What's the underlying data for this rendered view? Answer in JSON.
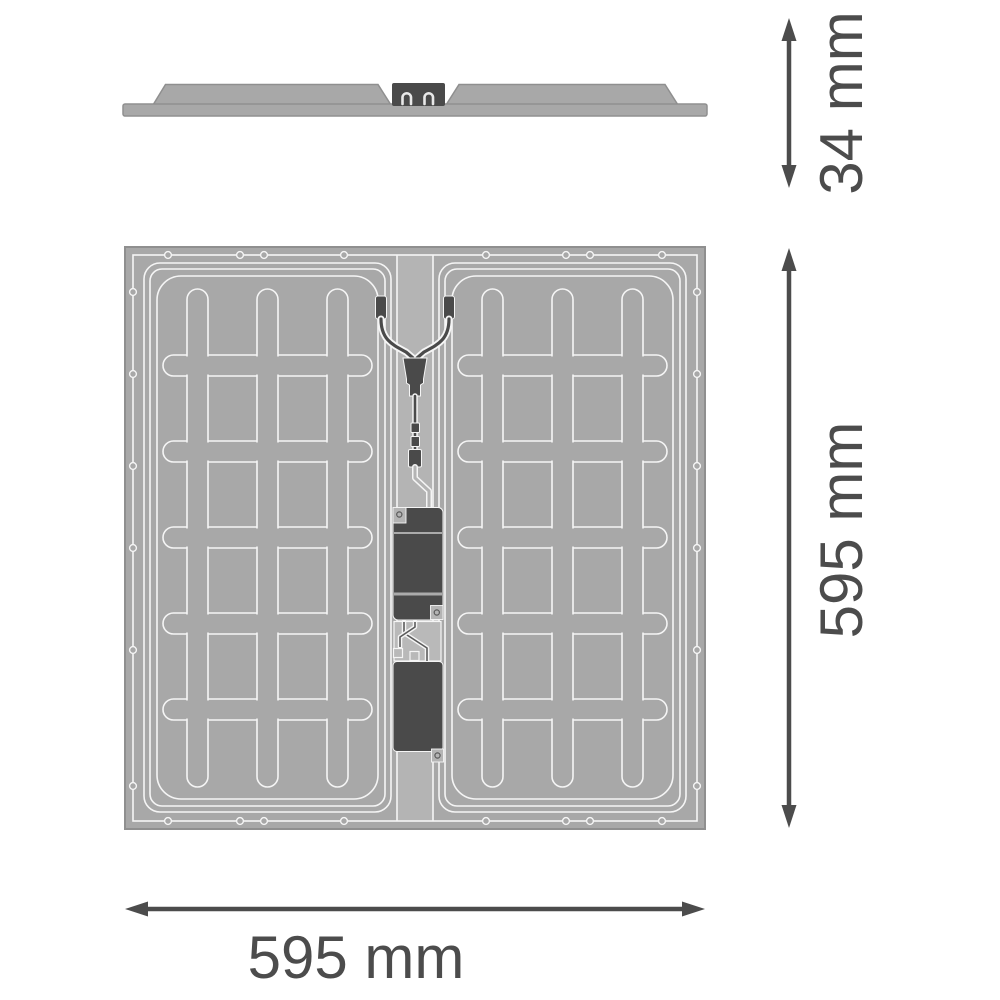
{
  "dimension_labels": {
    "profile_height": "34 mm",
    "panel_height": "595 mm",
    "panel_width": "595 mm"
  },
  "colors": {
    "body_gray": "#a8a8a8",
    "strip_gray": "#b4b4b4",
    "connector_gray": "#b9b9b9",
    "dark_gray": "#4a4a4a",
    "line_white": "#f5f5f5",
    "edge_gray": "#8f8f8f",
    "dim_gray": "#4c4c4c",
    "background": "#ffffff"
  }
}
